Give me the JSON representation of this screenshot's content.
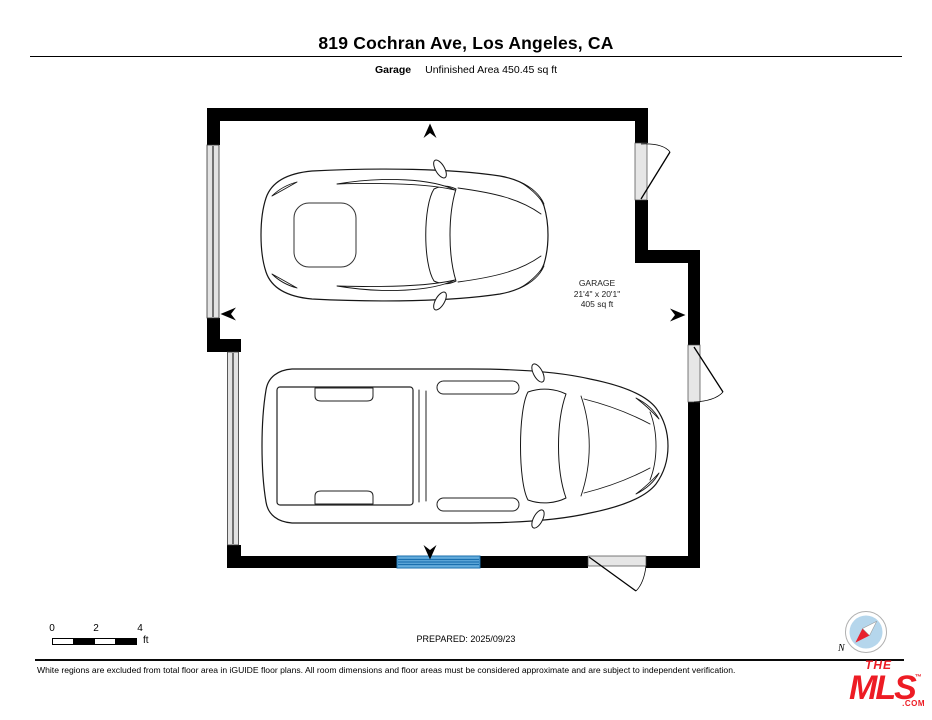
{
  "header": {
    "title": "819 Cochran Ave, Los Angeles, CA",
    "floor_name": "Garage",
    "floor_area_note": "Unfinished Area 450.45 sq ft"
  },
  "plan": {
    "room": {
      "name": "GARAGE",
      "dimensions": "21'4\" x 20'1\"",
      "area": "405 sq ft"
    },
    "icons": {
      "direction_arrows": [
        "up",
        "left",
        "right",
        "down"
      ],
      "vehicles": [
        "coupe-top-view",
        "pickup-truck-top-view"
      ]
    }
  },
  "colors": {
    "wall": "#000000",
    "door_opening_gray": "#e6e6e6",
    "window_blue_fill": "#64acdc",
    "window_blue_line": "#1a6fae",
    "compass_disc_blue": "#b5d6ec",
    "compass_needle_red": "#e8212e",
    "logo_red": "#ed1c24"
  },
  "footer": {
    "scale_ticks": [
      "0",
      "2",
      "4"
    ],
    "scale_unit": "ft",
    "prepared": "PREPARED: 2025/09/23",
    "compass_north_label": "N",
    "disclaimer": "White regions are excluded from total floor area in iGUIDE floor plans. All room dimensions and floor areas must be considered approximate and are subject to independent verification.",
    "logo": {
      "line1": "THE",
      "line2": "MLS",
      "tm": "™",
      "suffix": ".COM"
    }
  }
}
